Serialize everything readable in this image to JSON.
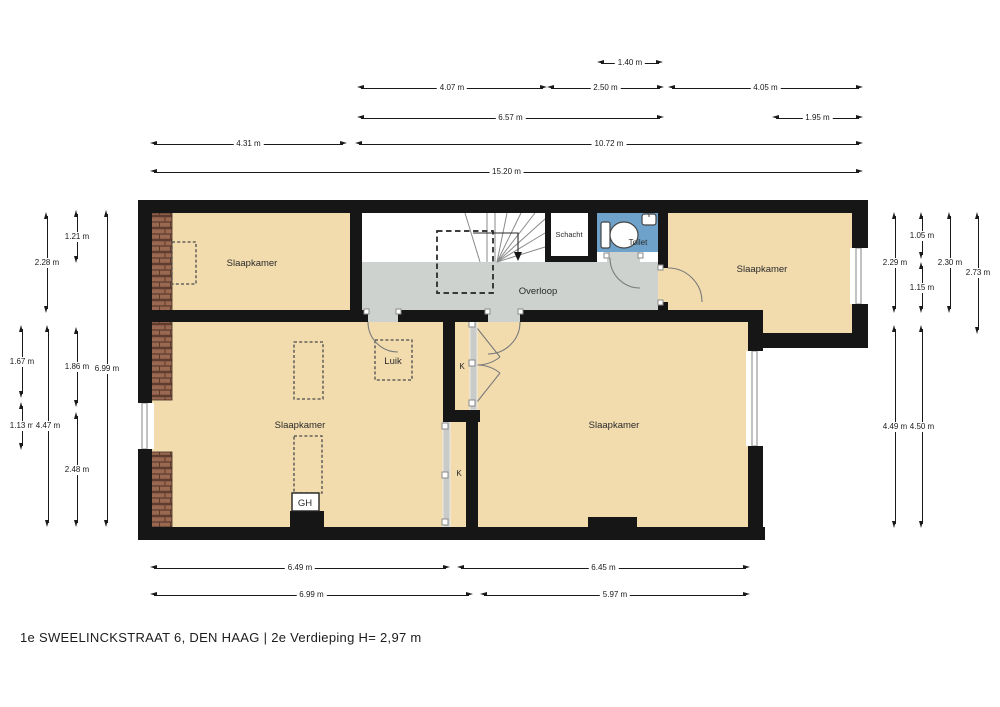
{
  "title": "1e SWEELINCKSTRAAT 6, DEN HAAG | 2e Verdieping H= 2,97 m",
  "labels": {
    "bedroom": "Slaapkamer",
    "landing": "Overloop",
    "shaft": "Schacht",
    "toilet": "Toilet",
    "hatch": "Luik",
    "closet": "K",
    "geyser": "GH"
  },
  "colors": {
    "wall": "#161616",
    "room": "#f2dcae",
    "landing": "#cdd2cf",
    "toilet": "#6fa2ca",
    "brick": "#9a6850",
    "brick_line": "#5e3c2e",
    "dim": "#1a1a1a"
  },
  "dimensions": [
    {
      "side": "top",
      "label": "1.40 m",
      "o": "h",
      "x1": 597,
      "x2": 663,
      "y": 63
    },
    {
      "side": "top",
      "label": "4.07 m",
      "o": "h",
      "x1": 357,
      "x2": 547,
      "y": 88
    },
    {
      "side": "top",
      "label": "2.50 m",
      "o": "h",
      "x1": 547,
      "x2": 664,
      "y": 88
    },
    {
      "side": "top",
      "label": "4.05 m",
      "o": "h",
      "x1": 668,
      "x2": 863,
      "y": 88
    },
    {
      "side": "top",
      "label": "6.57 m",
      "o": "h",
      "x1": 357,
      "x2": 664,
      "y": 118
    },
    {
      "side": "top",
      "label": "1.95 m",
      "o": "h",
      "x1": 772,
      "x2": 863,
      "y": 118
    },
    {
      "side": "top",
      "label": "4.31 m",
      "o": "h",
      "x1": 150,
      "x2": 347,
      "y": 144
    },
    {
      "side": "top",
      "label": "10.72 m",
      "o": "h",
      "x1": 355,
      "x2": 863,
      "y": 144
    },
    {
      "side": "top",
      "label": "15.20 m",
      "o": "h",
      "x1": 150,
      "x2": 863,
      "y": 172
    },
    {
      "side": "left",
      "label": "1.21 m",
      "o": "v",
      "x": 77,
      "y1": 210,
      "y2": 263
    },
    {
      "side": "left",
      "label": "2.28 m",
      "o": "v",
      "x": 47,
      "y1": 212,
      "y2": 313
    },
    {
      "side": "left",
      "label": "6.99 m",
      "o": "v",
      "x": 107,
      "y1": 210,
      "y2": 527
    },
    {
      "side": "left",
      "label": "1.67 m",
      "o": "v",
      "x": 22,
      "y1": 325,
      "y2": 398
    },
    {
      "side": "left",
      "label": "1.86 m",
      "o": "v",
      "x": 77,
      "y1": 327,
      "y2": 407
    },
    {
      "side": "left",
      "label": "1.13 m",
      "o": "v",
      "x": 22,
      "y1": 402,
      "y2": 450
    },
    {
      "side": "left",
      "label": "4.47 m",
      "o": "v",
      "x": 48,
      "y1": 325,
      "y2": 527
    },
    {
      "side": "left",
      "label": "2.48 m",
      "o": "v",
      "x": 77,
      "y1": 412,
      "y2": 527
    },
    {
      "side": "right",
      "label": "1.05 m",
      "o": "v",
      "x": 922,
      "y1": 212,
      "y2": 259
    },
    {
      "side": "right",
      "label": "2.29 m",
      "o": "v",
      "x": 895,
      "y1": 212,
      "y2": 313
    },
    {
      "side": "right",
      "label": "2.30 m",
      "o": "v",
      "x": 950,
      "y1": 212,
      "y2": 313
    },
    {
      "side": "right",
      "label": "2.73 m",
      "o": "v",
      "x": 978,
      "y1": 212,
      "y2": 334
    },
    {
      "side": "right",
      "label": "1.15 m",
      "o": "v",
      "x": 922,
      "y1": 262,
      "y2": 313
    },
    {
      "side": "right",
      "label": "4.49 m",
      "o": "v",
      "x": 895,
      "y1": 325,
      "y2": 528
    },
    {
      "side": "right",
      "label": "4.50 m",
      "o": "v",
      "x": 922,
      "y1": 325,
      "y2": 528
    },
    {
      "side": "bottom",
      "label": "6.49 m",
      "o": "h",
      "x1": 150,
      "x2": 450,
      "y": 568
    },
    {
      "side": "bottom",
      "label": "6.45 m",
      "o": "h",
      "x1": 457,
      "x2": 750,
      "y": 568
    },
    {
      "side": "bottom",
      "label": "6.99 m",
      "o": "h",
      "x1": 150,
      "x2": 473,
      "y": 595
    },
    {
      "side": "bottom",
      "label": "5.97 m",
      "o": "h",
      "x1": 480,
      "x2": 750,
      "y": 595
    }
  ]
}
